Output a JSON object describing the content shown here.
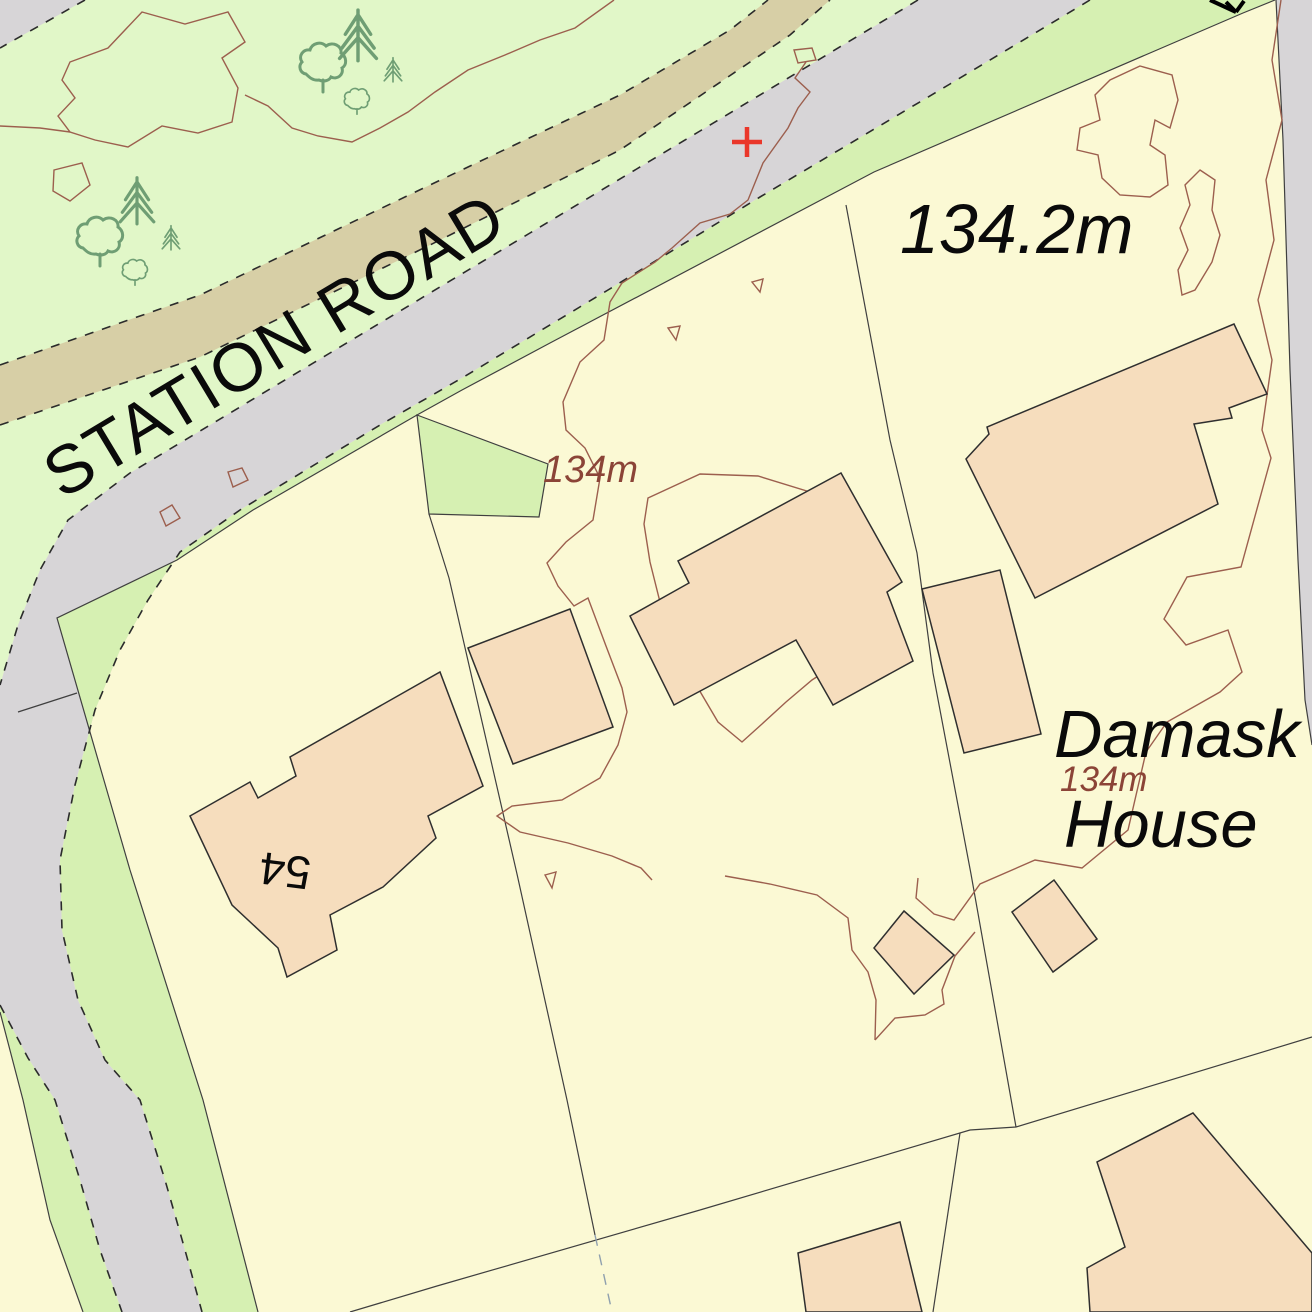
{
  "map": {
    "title": "OS-style large scale map extract",
    "labels": {
      "road_name": "STATION ROAD",
      "spot_height": "134.2m",
      "contour_label": "134m",
      "house_name_line1": "Damask",
      "house_name_line2": "House",
      "house_number": "54"
    },
    "icons": {
      "survey_cross": "red plus mark on carriageway",
      "flow_arrow": "small black arrow at top boundary",
      "conifer_tree": "outlined conifer symbol",
      "deciduous_tree": "outlined broadleaf tree symbol"
    },
    "colors": {
      "parcel": "#fbf9d4",
      "rough_grassland": "#e1f7c8",
      "verge": "#d6f0b2",
      "road": "#d7d5d7",
      "track": "#d7cfa6",
      "building_fill": "#f6ddbd",
      "building_outline": "#2f2f2f",
      "contour": "#9c5f4e",
      "contour_text": "#8b4437",
      "boundary": "#3f3f3f",
      "survey_cross": "#ea372a",
      "text": "#0a0a0a"
    }
  }
}
